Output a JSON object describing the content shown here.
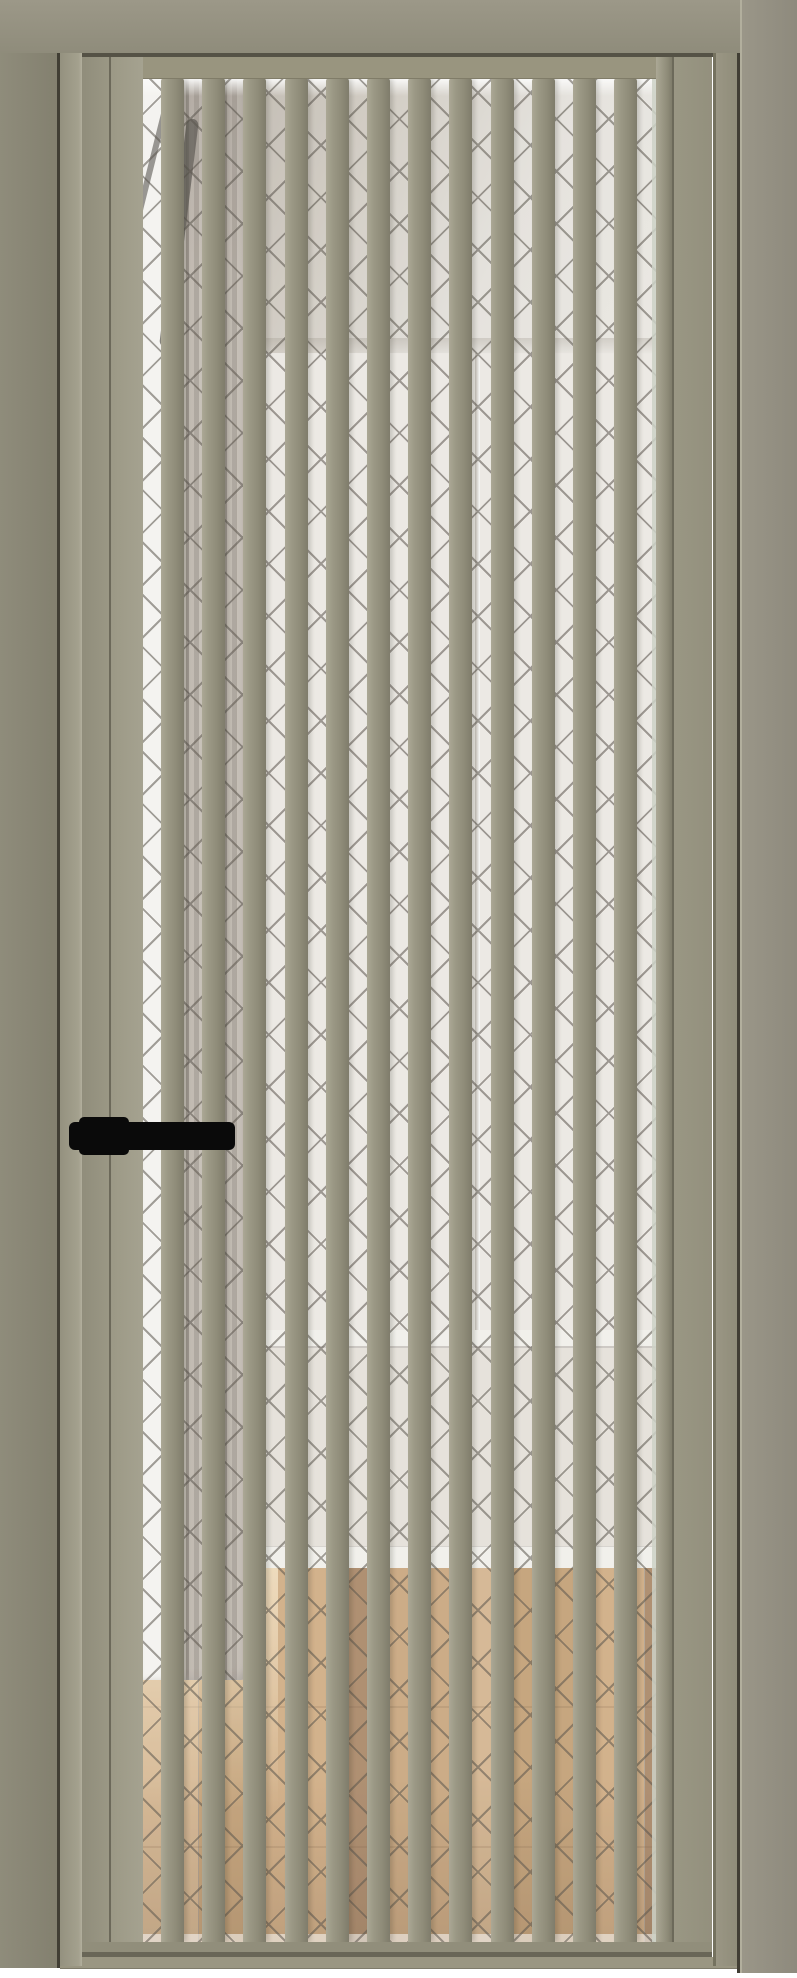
{
  "image": {
    "width_px": 797,
    "height_px": 1978,
    "background": "#ffffff",
    "subject": "interior door render: greige frame and leaf with vertical slats over clear lattice-pattern glass, black lever handle, room interior visible through glass"
  },
  "colors": {
    "frame_mid": "#8f8c7b",
    "frame_dark": "#83806f",
    "frame_light": "#9c9888",
    "frame_highlight": "#b2af9d",
    "groove_dark": "#413e34",
    "rail": "#99957f",
    "slat_light": "#aba895",
    "slat_mid": "#8f8c79",
    "slat_dark": "#7f7c6b",
    "glass_edge": "#ccd1c6",
    "lattice_line": "#433d34",
    "scene_white": "#ffffff",
    "ceiling_shade": "#b0a89e",
    "wall": "#edeae5",
    "wall_lower": "#e6e2db",
    "skirting": "#f4f2ee",
    "curtain_base": "#aaa198",
    "window_light": "#f7f6f3",
    "wood_light": "#d3b189",
    "wood_mid": "#c09a6d",
    "wood_dark": "#a5805e",
    "handle_black": "#0a0a0a"
  },
  "door": {
    "slats": {
      "count": 12,
      "first_left_px": 161,
      "pitch_px": 41.2,
      "width_px": 23,
      "top_px": 78,
      "height_px": 1864
    },
    "glass": {
      "left_px": 143,
      "top_px": 78,
      "width_px": 513,
      "height_px": 1879,
      "lattice_period_px": 37,
      "pattern": "diagonal cross lattice"
    },
    "handle": {
      "side": "left",
      "style": "black lever on rectangular base",
      "lever_center_y_px": 1136
    }
  },
  "scene_behind_glass": {
    "elements": [
      "bright window light strip",
      "sheer curtain with folds",
      "white ceiling",
      "white walls with corner line",
      "far skirting line",
      "white skirting board",
      "oak plank floor with sunlight patch"
    ]
  }
}
